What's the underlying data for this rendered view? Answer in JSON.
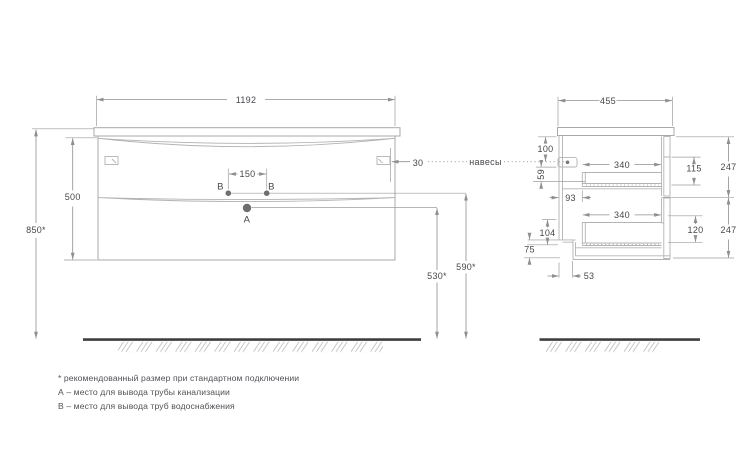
{
  "labels": {
    "hangers": "навесы",
    "point_a": "А",
    "point_b": "В"
  },
  "dims": {
    "front": {
      "width": "1192",
      "height": "500",
      "total_height": "850*",
      "hanger_inset": "30",
      "supply_spacing": "150",
      "drain_height": "530*",
      "supply_height": "590*"
    },
    "side": {
      "depth": "455",
      "top_to_hanger": "100",
      "hanger_drop": "59",
      "back_offset": "93",
      "upper_drawer_depth": "340",
      "lower_drawer_depth": "340",
      "upper_drawer_inner": "115",
      "lower_drawer_inner": "120",
      "upper_front": "247",
      "lower_front": "247",
      "bottom_back_offset": "104",
      "plinth": "75",
      "notch_depth": "53"
    }
  },
  "footnotes": [
    "* рекомендованный размер при стандартном подключении",
    "А – место для вывода трубы канализации",
    "В – место для вывода труб водоснабжения"
  ],
  "colors": {
    "line": "#a9a9a9",
    "dim": "#8f8f8f",
    "text": "#47474c",
    "floor": "#3f3f3f"
  }
}
